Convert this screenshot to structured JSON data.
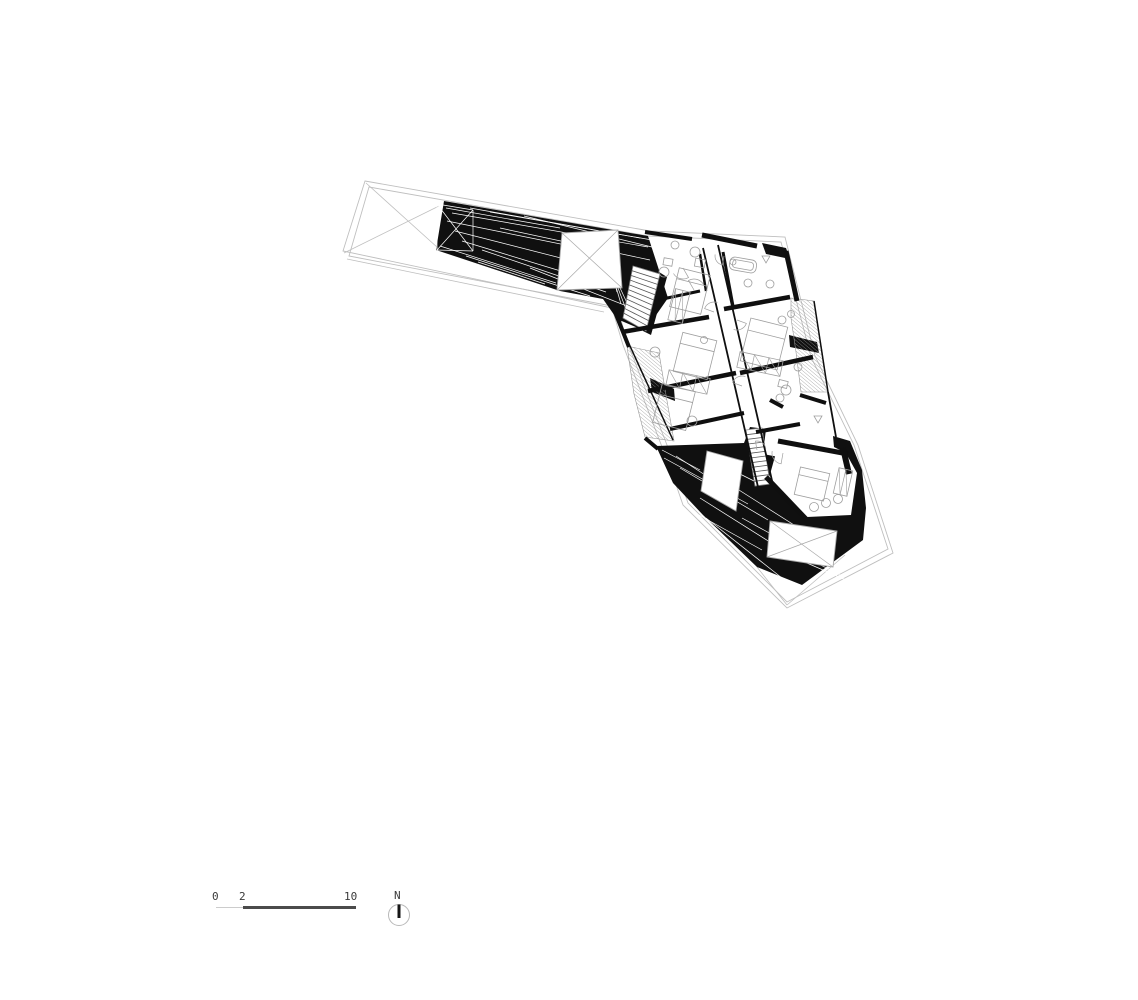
{
  "scale_bar": {
    "labels": [
      {
        "text": "0",
        "x": 212,
        "y": 891
      },
      {
        "text": "2",
        "x": 239,
        "y": 891
      },
      {
        "text": "10",
        "x": 344,
        "y": 891
      }
    ],
    "thin_line": {
      "x": 216,
      "y": 907,
      "w": 27,
      "h": 1,
      "color": "#cccccc"
    },
    "thick_line": {
      "x": 243,
      "y": 906,
      "w": 113,
      "h": 2.5,
      "color": "#4b4b4b"
    }
  },
  "north_indicator": {
    "label": "N",
    "label_x": 394,
    "label_y": 890,
    "box": {
      "left": 386,
      "top": 902,
      "size": 26
    },
    "circle": {
      "cx": 13,
      "cy": 13,
      "r": 10.5,
      "stroke": "#b8b8b8"
    },
    "needle": {
      "x": 13,
      "y1": 2.5,
      "y2": 16,
      "width": 3,
      "color": "#161616"
    }
  },
  "plan": {
    "colors": {
      "outline": "#bfbfbf",
      "black": "#101010",
      "wall": "#0f0f0f",
      "furniture": "#9e9e9e",
      "hatch": "#969696",
      "streak": "#ffffff",
      "rung": "#565656",
      "white_stroke": "#a8a8a8"
    },
    "thin_polys": [
      [
        [
          365,
          181
        ],
        [
          650,
          231
        ],
        [
          785,
          237
        ],
        [
          815,
          356
        ],
        [
          858,
          445
        ],
        [
          893,
          553
        ],
        [
          787,
          608
        ],
        [
          683,
          505
        ],
        [
          672,
          473
        ],
        [
          623,
          345
        ],
        [
          612,
          308
        ],
        [
          343,
          251
        ]
      ],
      [
        [
          369,
          187
        ],
        [
          648,
          236
        ],
        [
          781,
          242
        ],
        [
          811,
          357
        ],
        [
          854,
          445
        ],
        [
          888,
          549
        ],
        [
          787,
          602
        ],
        [
          688,
          503
        ],
        [
          677,
          471
        ],
        [
          628,
          344
        ],
        [
          617,
          307
        ],
        [
          349,
          256
        ]
      ]
    ],
    "aux_lines": [
      [
        344,
        253,
        439,
        206
      ],
      [
        366,
        183,
        438,
        248
      ],
      [
        347,
        259,
        604,
        312
      ],
      [
        787,
        605,
        757,
        567
      ],
      [
        787,
        605,
        845,
        555
      ]
    ],
    "black_polys": [
      [
        [
          444,
          201
        ],
        [
          648,
          236
        ],
        [
          668,
          298
        ],
        [
          645,
          331
        ],
        [
          617,
          319
        ],
        [
          603,
          299
        ],
        [
          560,
          291
        ],
        [
          436,
          250
        ]
      ],
      [
        [
          606,
          257
        ],
        [
          637,
          262
        ],
        [
          621,
          322
        ],
        [
          602,
          297
        ]
      ],
      [
        [
          659,
          272
        ],
        [
          667,
          277
        ],
        [
          651,
          335
        ],
        [
          643,
          331
        ]
      ],
      [
        [
          762,
          243
        ],
        [
          786,
          248
        ],
        [
          790,
          259
        ],
        [
          766,
          254
        ]
      ],
      [
        [
          789,
          335
        ],
        [
          817,
          342
        ],
        [
          819,
          353
        ],
        [
          790,
          347
        ]
      ],
      [
        [
          650,
          378
        ],
        [
          674,
          389
        ],
        [
          675,
          401
        ],
        [
          652,
          392
        ]
      ],
      [
        [
          656,
          446
        ],
        [
          744,
          443
        ],
        [
          750,
          427
        ],
        [
          766,
          429
        ],
        [
          763,
          454
        ],
        [
          820,
          465
        ],
        [
          846,
          453
        ],
        [
          834,
          447
        ],
        [
          833,
          436
        ],
        [
          850,
          441
        ],
        [
          862,
          470
        ],
        [
          866,
          508
        ],
        [
          863,
          540
        ],
        [
          802,
          585
        ],
        [
          757,
          567
        ],
        [
          703,
          515
        ],
        [
          673,
          483
        ]
      ]
    ],
    "white_streaks": [
      [
        452,
        213,
        648,
        247
      ],
      [
        447,
        221,
        620,
        256
      ],
      [
        455,
        231,
        600,
        268
      ],
      [
        462,
        241,
        610,
        286
      ],
      [
        470,
        208,
        652,
        240
      ],
      [
        482,
        250,
        606,
        292
      ],
      [
        440,
        246,
        556,
        283
      ],
      [
        500,
        228,
        650,
        260
      ],
      [
        524,
        216,
        656,
        248
      ],
      [
        446,
        208,
        560,
        228
      ],
      [
        466,
        256,
        590,
        296
      ],
      [
        530,
        268,
        642,
        312
      ],
      [
        478,
        262,
        545,
        284
      ],
      [
        490,
        212,
        640,
        238
      ],
      [
        664,
        458,
        748,
        504
      ],
      [
        680,
        468,
        768,
        520
      ],
      [
        700,
        498,
        792,
        556
      ],
      [
        676,
        456,
        728,
        490
      ],
      [
        742,
        518,
        822,
        562
      ],
      [
        772,
        540,
        842,
        576
      ],
      [
        690,
        510,
        762,
        550
      ],
      [
        800,
        560,
        846,
        580
      ],
      [
        662,
        450,
        700,
        470
      ],
      [
        720,
        478,
        802,
        530
      ],
      [
        752,
        468,
        832,
        508
      ],
      [
        706,
        518,
        782,
        578
      ],
      [
        712,
        460,
        756,
        482
      ],
      [
        608,
        262,
        634,
        318
      ],
      [
        609,
        264,
        627,
        312
      ],
      [
        610,
        266,
        621,
        304
      ],
      [
        611,
        268,
        617,
        292
      ],
      [
        437,
        204,
        473,
        251
      ],
      [
        473,
        210,
        437,
        250
      ],
      [
        437,
        204,
        473,
        210
      ],
      [
        473,
        251,
        437,
        250
      ],
      [
        437,
        204,
        437,
        250
      ],
      [
        473,
        210,
        473,
        251
      ]
    ],
    "hatches": [
      {
        "pts": [
          [
            791,
            298
          ],
          [
            814,
            301
          ],
          [
            822,
            350
          ],
          [
            828,
            392
          ],
          [
            801,
            392
          ],
          [
            796,
            352
          ],
          [
            791,
            318
          ]
        ],
        "spacing": 2.7,
        "angle": 40
      },
      {
        "pts": [
          [
            627,
            346
          ],
          [
            659,
            353
          ],
          [
            666,
            395
          ],
          [
            674,
            441
          ],
          [
            645,
            437
          ],
          [
            634,
            394
          ]
        ],
        "spacing": 2.7,
        "angle": 40
      }
    ],
    "white_polys": [
      {
        "pts": [
          [
            562,
            233
          ],
          [
            618,
            230
          ],
          [
            622,
            288
          ],
          [
            557,
            290
          ]
        ],
        "stroke": true,
        "x_mark": true
      },
      {
        "pts": [
          [
            707,
            451
          ],
          [
            743,
            461
          ],
          [
            736,
            511
          ],
          [
            701,
            491
          ]
        ],
        "stroke": true,
        "x_mark": false
      },
      {
        "pts": [
          [
            770,
            521
          ],
          [
            837,
            531
          ],
          [
            833,
            567
          ],
          [
            767,
            557
          ]
        ],
        "stroke": true,
        "x_mark": true
      },
      {
        "pts": [
          [
            779,
            442
          ],
          [
            847,
            455
          ],
          [
            857,
            473
          ],
          [
            851,
            515
          ],
          [
            807,
            517
          ],
          [
            769,
            478
          ]
        ],
        "stroke": false,
        "x_mark": false
      }
    ],
    "stairs": [
      {
        "a": [
          [
            633,
            266
          ],
          [
            623,
            318
          ]
        ],
        "b": [
          [
            660,
            274
          ],
          [
            646,
            331
          ]
        ],
        "n": 11
      },
      {
        "a": [
          [
            746,
            430
          ],
          [
            755,
            486
          ]
        ],
        "b": [
          [
            762,
            428
          ],
          [
            770,
            484
          ]
        ],
        "n": 12
      }
    ],
    "walls": [
      [
        645,
        232,
        692,
        239,
        4
      ],
      [
        702,
        235,
        757,
        246,
        5
      ],
      [
        786,
        251,
        797,
        301,
        5
      ],
      [
        703,
        248,
        758,
        487,
        1.8
      ],
      [
        718,
        245,
        773,
        485,
        1.8
      ],
      [
        622,
        332,
        709,
        317,
        4.5
      ],
      [
        648,
        391,
        736,
        373,
        4.5
      ],
      [
        670,
        429,
        744,
        413,
        4
      ],
      [
        724,
        309,
        790,
        297,
        4.5
      ],
      [
        740,
        373,
        813,
        357,
        4.5
      ],
      [
        756,
        432,
        800,
        424,
        4
      ],
      [
        778,
        441,
        848,
        454,
        5
      ],
      [
        766,
        477,
        806,
        519,
        5
      ],
      [
        843,
        448,
        849,
        474,
        6
      ],
      [
        615,
        312,
        629,
        347,
        4
      ],
      [
        645,
        438,
        658,
        449,
        4
      ],
      [
        723,
        252,
        733,
        306,
        3
      ],
      [
        800,
        395,
        826,
        403,
        4
      ],
      [
        770,
        400,
        783,
        407,
        4
      ],
      [
        828,
        392,
        836,
        437,
        1.8
      ],
      [
        630,
        346,
        673,
        440,
        1.5
      ],
      [
        814,
        301,
        828,
        392,
        1.5
      ],
      [
        658,
        300,
        700,
        291,
        3
      ],
      [
        700,
        254,
        706,
        291,
        2.5
      ]
    ],
    "furniture": {
      "beds": [
        {
          "cx": 690,
          "cy": 291,
          "w": 32,
          "h": 40,
          "rot": 14
        },
        {
          "cx": 695,
          "cy": 356,
          "w": 35,
          "h": 40,
          "rot": 14
        },
        {
          "cx": 674,
          "cy": 407,
          "w": 34,
          "h": 40,
          "rot": 14
        },
        {
          "cx": 764,
          "cy": 344,
          "w": 38,
          "h": 44,
          "rot": 14
        },
        {
          "cx": 812,
          "cy": 484,
          "w": 30,
          "h": 28,
          "rot": 13
        }
      ],
      "wardrobes": [
        {
          "cx": 688,
          "cy": 382,
          "w": 42,
          "h": 16,
          "rot": 12,
          "cells": 3
        },
        {
          "cx": 760,
          "cy": 364,
          "w": 44,
          "h": 16,
          "rot": 12,
          "cells": 3
        },
        {
          "cx": 679,
          "cy": 306,
          "w": 15,
          "h": 32,
          "rot": 14,
          "cells": 2
        },
        {
          "cx": 843,
          "cy": 482,
          "w": 14,
          "h": 26,
          "rot": 13,
          "cells": 2
        }
      ],
      "circles": [
        [
          695,
          252,
          5
        ],
        [
          675,
          245,
          4
        ],
        [
          770,
          284,
          4
        ],
        [
          748,
          283,
          4
        ],
        [
          664,
          272,
          5
        ],
        [
          655,
          352,
          5
        ],
        [
          704,
          340,
          3.5
        ],
        [
          692,
          421,
          5
        ],
        [
          782,
          320,
          4
        ],
        [
          791,
          314,
          3.5
        ],
        [
          786,
          390,
          5
        ],
        [
          780,
          398,
          4
        ],
        [
          798,
          367,
          4
        ],
        [
          814,
          507,
          4.5
        ],
        [
          826,
          503,
          4.5
        ],
        [
          838,
          499,
          4.5
        ],
        [
          733,
          262,
          3
        ]
      ],
      "small_rects": [
        {
          "cx": 700,
          "cy": 263,
          "w": 10,
          "h": 8,
          "rot": 10
        },
        {
          "cx": 783,
          "cy": 384,
          "w": 9,
          "h": 7,
          "rot": 14
        },
        {
          "cx": 668,
          "cy": 262,
          "w": 9,
          "h": 7,
          "rot": 10
        }
      ],
      "tub": {
        "cx": 743,
        "cy": 265,
        "w": 27,
        "h": 13,
        "rot": 10
      },
      "arcs": [
        {
          "cx": 683,
          "cy": 268,
          "r": 11,
          "a1": 60,
          "a2": 150
        },
        {
          "cx": 694,
          "cy": 290,
          "r": 11,
          "a1": 240,
          "a2": 330
        },
        {
          "cx": 714,
          "cy": 312,
          "r": 10,
          "a1": 200,
          "a2": 290
        },
        {
          "cx": 737,
          "cy": 320,
          "r": 10,
          "a1": 20,
          "a2": 110
        },
        {
          "cx": 742,
          "cy": 386,
          "r": 10,
          "a1": 200,
          "a2": 290
        },
        {
          "cx": 783,
          "cy": 453,
          "r": 11,
          "a1": 100,
          "a2": 190
        },
        {
          "cx": 724,
          "cy": 256,
          "r": 9,
          "a1": 100,
          "a2": 190
        },
        {
          "cx": 757,
          "cy": 450,
          "r": 9,
          "a1": 260,
          "a2": 350
        }
      ],
      "triangles": [
        [
          766,
          259
        ],
        [
          818,
          419
        ]
      ]
    }
  }
}
